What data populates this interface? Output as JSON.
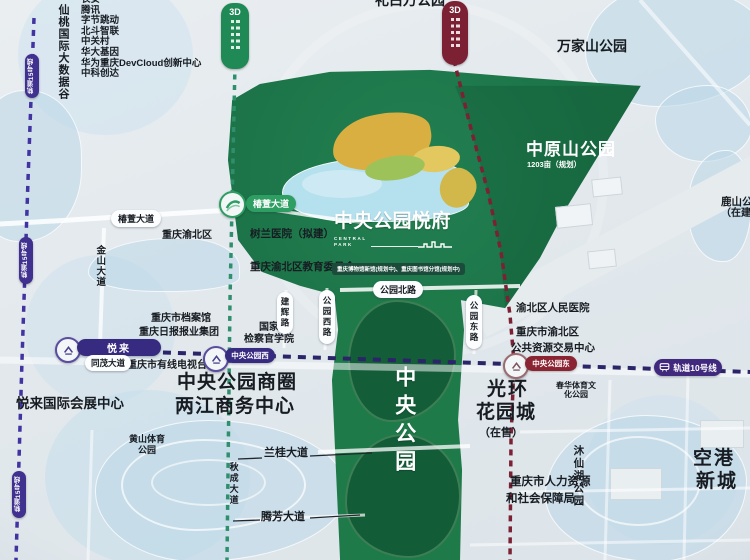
{
  "colors": {
    "park_green": "#1f7a4a",
    "park_dark_green": "#14603a",
    "gold": "#d9af42",
    "lake_blue": "#b5e0ee",
    "line10_navy": "#2b2468",
    "line15_purple": "#4133a0",
    "line_teal": "#2f8f6d",
    "line_maroon": "#7c2134",
    "station_pill_purple": "#372a81",
    "station_pill_maroon": "#8a2433",
    "green_badge": "#1f8a55",
    "green_road_pill": "#2e9e63"
  },
  "tech_valley": {
    "title": "仙桃国际大数据谷",
    "companies": [
      "长安",
      "腾讯",
      "字节跳动",
      "北斗智联",
      "中关村",
      "华大基因",
      "华为重庆DevCloud创新中心",
      "中科创达"
    ]
  },
  "project": {
    "title": "中央公园悦府",
    "subtitle_line1": "CENTRAL",
    "subtitle_line2": "PARK"
  },
  "parks": {
    "top_partial": "礼白万公园",
    "wanjiashan": "万家山公园",
    "zhongyuanshan": "中原山公园",
    "zhongyuanshan_area": "1203亩（规划）",
    "lushan_l1": "鹿山公园",
    "lushan_l2": "（在建）",
    "central_park": "中央公园",
    "chunhua_l1": "春华体育文",
    "chunhua_l2": "化公园",
    "huangshan_l1": "黄山体育",
    "huangshan_l2": "公园",
    "muxianhu": "沐仙湖公园"
  },
  "areas": {
    "yuelai_expo": "悦来国际会展中心",
    "biz_l1": "中央公园商圈",
    "biz_l2": "两江商务中心",
    "guanghuan_l1": "光环",
    "guanghuan_l2": "花园城",
    "guanghuan_status": "（在售）",
    "konggang_l1": "空港",
    "konggang_l2": "新城",
    "yubei_district": "重庆渝北区"
  },
  "pois": {
    "shulan": "树兰医院（拟建）",
    "edu": "重庆渝北区教育委员会",
    "museum_note": "重庆博物馆新馆(规划中)、重庆图书馆分馆(规划中)",
    "prosecutor_l1": "国家",
    "prosecutor_l2": "检察官学院",
    "archives": "重庆市档案馆",
    "press": "重庆日报报业集团",
    "cable_tv": "重庆市有线电视台",
    "hospital": "渝北区人民医院",
    "resource_l1": "重庆市渝北区",
    "resource_l2": "公共资源交易中心",
    "hr_l1": "重庆市人力资源",
    "hr_l2": "和社会保障局"
  },
  "roads": {
    "chunxuan": "椿萱大道",
    "jinshan": "金山大道",
    "tongmao": "同茂大道",
    "park_north": "公园北路",
    "park_west": "公园西路",
    "park_east": "公园东路",
    "jianhui": "建辉路",
    "langui": "兰桂大道",
    "qiucheng": "秋成大道",
    "tengfang": "腾芳大道"
  },
  "transit": {
    "station_yuelai": "悦来",
    "station_cp_west": "中央公园西",
    "station_cp_east": "中央公园东",
    "line10_badge": "轨道10号线",
    "line15_badge": "轨道15号线",
    "badge_3d": "3D"
  }
}
